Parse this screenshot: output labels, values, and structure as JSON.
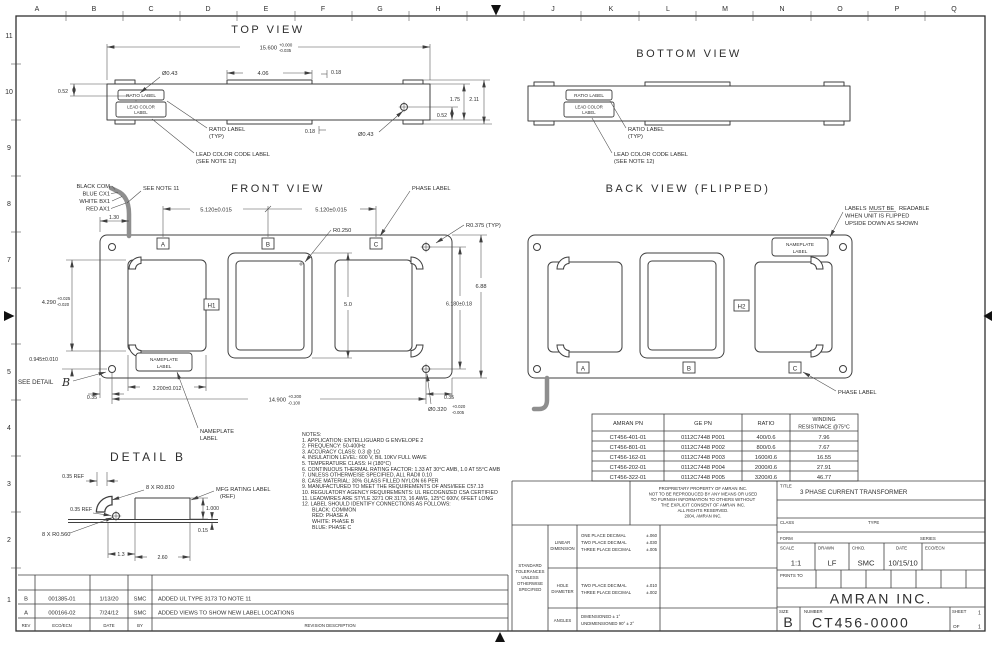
{
  "sheet": {
    "zones_top": [
      "A",
      "B",
      "C",
      "D",
      "E",
      "F",
      "G",
      "H",
      "J",
      "K",
      "L",
      "M",
      "N",
      "O",
      "P",
      "Q"
    ],
    "zones_left": [
      "11",
      "10",
      "9",
      "8",
      "7",
      "5",
      "4",
      "3",
      "2",
      "1"
    ]
  },
  "top_view": {
    "title": "TOP VIEW",
    "dim_width": "15.600",
    "dim_width_plus": "+0.000",
    "dim_width_minus": "-0.035",
    "dim_tab": "4.06",
    "dim_018_top": "0.18",
    "dim_018_bottom": "0.18",
    "dia_hole_left": "Ø0.43",
    "dia_hole_right": "Ø0.43",
    "dim_052_left": "0.52",
    "dim_052_right": "0.52",
    "dim_175": "1.75",
    "dim_211": "2.11",
    "ratio_box": "RATIO LABEL",
    "lead_box_1": "LEAD COLOR",
    "lead_box_2": "LABEL",
    "ratio_callout_1": "RATIO LABEL",
    "ratio_callout_2": "(TYP)",
    "lead_callout_1": "LEAD COLOR CODE LABEL",
    "lead_callout_2": "(SEE NOTE 12)"
  },
  "bottom_view": {
    "title": "BOTTOM VIEW",
    "ratio_box": "RATIO LABEL",
    "lead_box_1": "LEAD COLOR",
    "lead_box_2": "LABEL",
    "ratio_callout_1": "RATIO LABEL",
    "ratio_callout_2": "(TYP)",
    "lead_callout_1": "LEAD COLOR CODE LABEL",
    "lead_callout_2": "(SEE NOTE 12)"
  },
  "front_view": {
    "title": "FRONT VIEW",
    "wire_label_1": "BLACK COM",
    "wire_label_2": "BLUE CX1",
    "wire_label_3": "WHITE BX1",
    "wire_label_4": "RED AX1",
    "see_note": "SEE NOTE 11",
    "phase_label": "PHASE LABEL",
    "dim_pitch_left": "5.120±0.015",
    "dim_pitch_right": "5.120±0.015",
    "dim_130": "1.30",
    "r_window": "R0.250",
    "r_corner": "R0.375 (TYP)",
    "dim_height_overall": "6.88",
    "dim_hole_v": "6.180±0.18",
    "dim_window_h": "5.0",
    "dim_4290": "4.290",
    "dim_4290_plus": "+0.025",
    "dim_4290_minus": "-0.020",
    "dim_0945": "0.945±0.010",
    "see_detail": "SEE DETAIL",
    "detail_ref": "B",
    "dim_035_left": "0.35",
    "dim_3200": "3.200±0.012",
    "dim_14900": "14.900",
    "dim_14900_plus": "+0.200",
    "dim_14900_minus": "-0.100",
    "dim_035_right": "0.35",
    "dia_mount": "Ø0.320",
    "dia_mount_plus": "+0.020",
    "dia_mount_minus": "-0.005",
    "h1": "H1",
    "phase_a": "A",
    "phase_b": "B",
    "phase_c": "C",
    "nameplate_1": "NAMEPLATE",
    "nameplate_2": "LABEL",
    "nameplate_callout_1": "NAMEPLATE",
    "nameplate_callout_2": "LABEL"
  },
  "back_view": {
    "title": "BACK VIEW (FLIPPED)",
    "note_a": "LABELS",
    "note_b": "MUST BE",
    "note_c": "READABLE",
    "note_line2": "WHEN UNIT IS FLIPPED",
    "note_line3": "UPSIDE DOWN AS SHOWN",
    "nameplate_1": "NAMEPLATE",
    "nameplate_2": "LABEL",
    "h2": "H2",
    "phase_a": "A",
    "phase_b": "B",
    "phase_c": "C",
    "phase_label": "PHASE LABEL"
  },
  "detail_b": {
    "title": "DETAIL B",
    "dim_035_ref_top": "0.35 REF",
    "r_slot": "8 X R0.810",
    "mfg_1": "MFG RATING LABEL",
    "mfg_2": "(REF)",
    "dim_035_ref_left": "0.35 REF",
    "dim_1000": "1.000",
    "dim_015": "0.15",
    "r_hole": "8 X R0.560",
    "dim_13": "1.3",
    "dim_260": "2.60"
  },
  "notes": {
    "lines": [
      "NOTES:",
      "1. APPLICATION: ENTELLIGUARD G ENVELOPE 2",
      "2. FREQUENCY: 50-400Hz",
      "3. ACCURACY CLASS: 0.3 @ 1Ω",
      "4. INSULATION LEVEL: 600 V, BIL 10KV FULL WAVE",
      "5. TEMPERATURE CLASS: H (180°C)",
      "6. CONTINUOUS THERMAL RATING FACTOR: 1.33 AT 30°C AMB, 1.0 AT 55°C AMB",
      "7. UNLESS OTHERWEISE SPECIFIED, ALL RADII 0.10",
      "8. CASE MATERIAL: 30% GLASS FILLED NYLON 66 PER",
      "9. MANUFACTURED TO MEET THE REQUIREMENTS OF ANSI/IEEE C57.13",
      "10. REGULATORY AGENCY REQUIREMENTS: UL RECOGNIZED CSA CERTIFIED",
      "11. LEADWIRES ARE STYLE 3271 OR 3173, 16 AWG, 125°C 600V, 6FEET LONG",
      "12. LABEL SHOULD IDENTIFY CONNECTIONS AS FOLLOWS:",
      "BLACK: COMMON",
      "RED: PHASE A",
      "WHITE: PHASE B",
      "BLUE: PHASE C"
    ]
  },
  "pn_table": {
    "h_amran": "AMRAN PN",
    "h_ge": "GE PN",
    "h_ratio": "RATIO",
    "h_wind_1": "WINDING",
    "h_wind_2": "RESISTNACE @75°C",
    "rows": [
      [
        "CT456-401-01",
        "0112C7448 P001",
        "400/0.6",
        "7.96"
      ],
      [
        "CT456-801-01",
        "0112C7448 P002",
        "800/0.6",
        "7.67"
      ],
      [
        "CT456-162-01",
        "0112C7448 P003",
        "1600/0.6",
        "16.55"
      ],
      [
        "CT456-202-01",
        "0112C7448 P004",
        "2000/0.6",
        "27.91"
      ],
      [
        "CT456-322-01",
        "0112C7448 P005",
        "3200/0.6",
        "46.77"
      ]
    ]
  },
  "proprietary": {
    "lines": [
      "PROPRIETARY PROPERTY OF AMRAN INC.",
      "NOT TO BE REPRODUCED BY ANY MEANS OR USED",
      "TO FURNISH INFORMATION TO OTHERS WITHOUT",
      "THE EXPLICIT CONSENT OF AMRAN INC.",
      "ALL RIGHTS RESERVED.",
      "2004, AMRAN INC."
    ]
  },
  "tolerances": {
    "std": [
      "STANDARD",
      "TOLERANCES",
      "UNLESS",
      "OTHERWISE",
      "SPECIFIED"
    ],
    "linear_label_1": "LINEAR",
    "linear_label_2": "DIMENSION",
    "linear_rows": [
      [
        "ONE PLACE DECIMAL",
        "±.060"
      ],
      [
        "TWO PLACE DECIMAL",
        "±.030"
      ],
      [
        "THREE PLACE DECIMAL",
        "±.005"
      ]
    ],
    "hole_label_1": "HOLE",
    "hole_label_2": "DIAMETER",
    "hole_rows": [
      [
        "TWO PLACE DECIMAL",
        "±.010"
      ],
      [
        "THREE PLACE DECIMAL",
        "±.002"
      ]
    ],
    "angles_label": "ANGLES",
    "angles_rows": [
      "DIMENSIONED ± 1°",
      "UNDIMENSIONED 90° ± 2°"
    ]
  },
  "title_block": {
    "title_label": "TITLE",
    "title": "3 PHASE CURRENT TRANSFORMER",
    "class_label": "CLASS",
    "type_label": "TYPE",
    "form_label": "FORM",
    "series_label": "SERIES",
    "scale_label": "SCALE",
    "scale": "1:1",
    "drawn_label": "DRAWN",
    "drawn": "LF",
    "chkd_label": "CHKD.",
    "chkd": "SMC",
    "date_label": "DATE",
    "date": "10/15/10",
    "eco_label": "ECO/ECN",
    "prints_label": "PRINTS TO",
    "company": "AMRAN INC.",
    "size_label": "SIZE",
    "size": "B",
    "number_label": "NUMBER",
    "number": "CT456-0000",
    "sheet_label": "SHEET",
    "sheet_num": "1",
    "of_label": "OF",
    "sheet_total": "1"
  },
  "revisions": {
    "headers": [
      "REV",
      "ECO/ECN",
      "DATE",
      "BY",
      "REVISION DESCRIPTION"
    ],
    "rows": [
      [
        "B",
        "001385-01",
        "1/13/20",
        "SMC",
        "ADDED UL TYPE 3173 TO NOTE 11"
      ],
      [
        "A",
        "000166-02",
        "7/24/12",
        "SMC",
        "ADDED VIEWS TO SHOW NEW LABEL LOCATIONS"
      ]
    ]
  }
}
